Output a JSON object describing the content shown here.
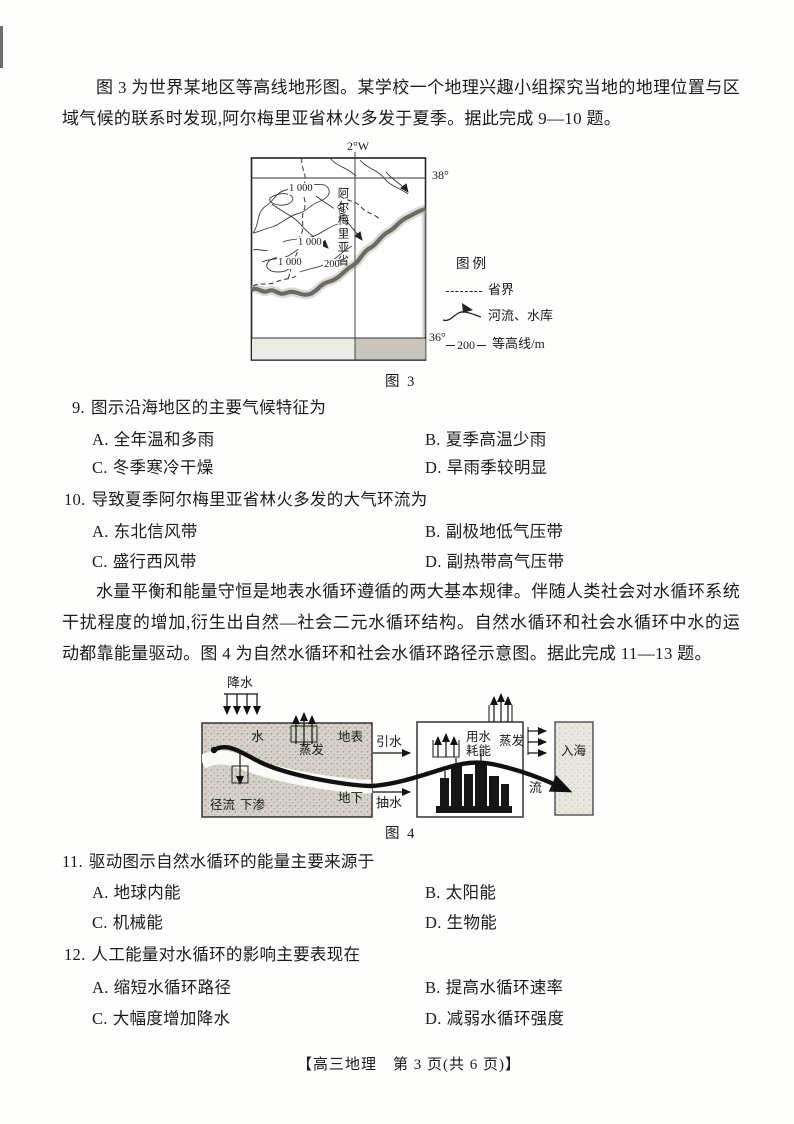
{
  "intro_q9_10": "图 3 为世界某地区等高线地形图。某学校一个地理兴趣小组探究当地的地理位置与区域气候的联系时发现,阿尔梅里亚省林火多发于夏季。据此完成 9—10 题。",
  "intro_q11_13": "水量平衡和能量守恒是地表水循环遵循的两大基本规律。伴随人类社会对水循环系统干扰程度的增加,衍生出自然—社会二元水循环结构。自然水循环和社会水循环中水的运动都靠能量驱动。图 4 为自然水循环和社会水循环路径示意图。据此完成 11—13 题。",
  "figure3": {
    "caption": "图 3",
    "meridian_label": "2°W",
    "parallel_top": "38°",
    "parallel_bottom": "36°",
    "province_name": "阿尔梅里亚省",
    "contour_labels": {
      "c1": "1 000",
      "c2": "000",
      "c3": "1 000",
      "c4": "1 000",
      "c5": "200"
    },
    "legend": {
      "title": "图例",
      "boundary_label": "省界",
      "river_label": "河流、水库",
      "contour_value": "200",
      "contour_label": "等高线/m"
    }
  },
  "figure4": {
    "caption": "图 4",
    "labels": {
      "precipitation": "降水",
      "water": "水",
      "evaporation_left": "蒸发",
      "surface": "地表",
      "runoff": "径流",
      "infiltration": "下渗",
      "underground": "地下",
      "diversion": "引水",
      "pumping": "抽水",
      "water_use_energy": "用水耗能",
      "evaporation_right": "蒸发",
      "flow": "流",
      "into_sea": "入海"
    }
  },
  "questions": [
    {
      "number": "9.",
      "stem": "图示沿海地区的主要气候特征为",
      "options": [
        {
          "label": "A.",
          "text": "全年温和多雨"
        },
        {
          "label": "B.",
          "text": "夏季高温少雨"
        },
        {
          "label": "C.",
          "text": "冬季寒冷干燥"
        },
        {
          "label": "D.",
          "text": "旱雨季较明显"
        }
      ]
    },
    {
      "number": "10.",
      "stem": "导致夏季阿尔梅里亚省林火多发的大气环流为",
      "options": [
        {
          "label": "A.",
          "text": "东北信风带"
        },
        {
          "label": "B.",
          "text": "副极地低气压带"
        },
        {
          "label": "C.",
          "text": "盛行西风带"
        },
        {
          "label": "D.",
          "text": "副热带高气压带"
        }
      ]
    },
    {
      "number": "11.",
      "stem": "驱动图示自然水循环的能量主要来源于",
      "options": [
        {
          "label": "A.",
          "text": "地球内能"
        },
        {
          "label": "B.",
          "text": "太阳能"
        },
        {
          "label": "C.",
          "text": "机械能"
        },
        {
          "label": "D.",
          "text": "生物能"
        }
      ]
    },
    {
      "number": "12.",
      "stem": "人工能量对水循环的影响主要表现在",
      "options": [
        {
          "label": "A.",
          "text": "缩短水循环路径"
        },
        {
          "label": "B.",
          "text": "提高水循环速率"
        },
        {
          "label": "C.",
          "text": "大幅度增加降水"
        },
        {
          "label": "D.",
          "text": "减弱水循环强度"
        }
      ]
    }
  ],
  "footer": "【高三地理　第 3 页(共 6 页)】"
}
